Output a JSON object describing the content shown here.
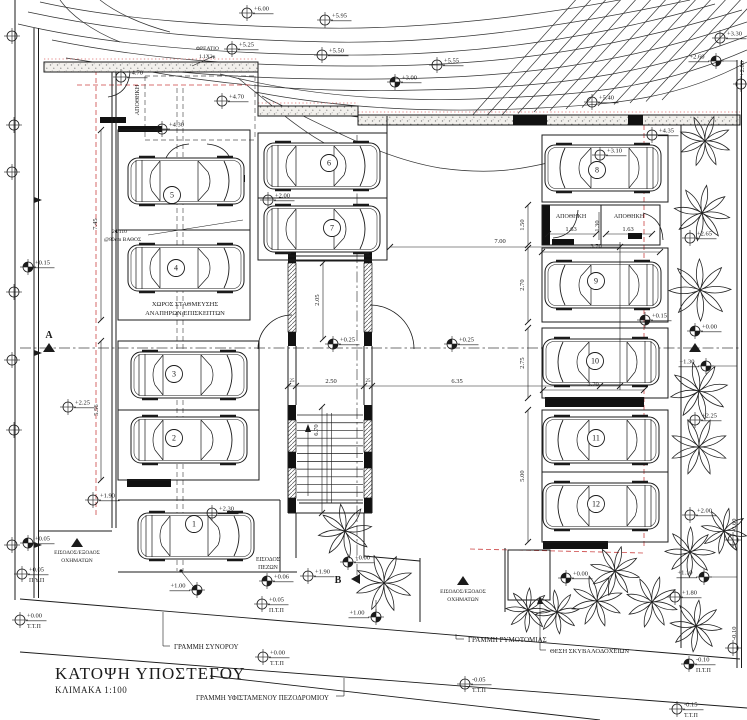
{
  "meta": {
    "title": "ΚΑΤΟΨΗ ΥΠΟΣΤΕΓΟΥ",
    "scale": "ΚΛΙΜΑΚΑ 1:100"
  },
  "palette": {
    "ink": "#1b1b1b",
    "red": "#cc4444",
    "paper": "#ffffff"
  },
  "contours": [
    "M40,2 C120,20 220,26 320,28 C420,30 540,16 640,-4",
    "M28,12 C130,34 230,40 330,42 C440,44 560,28 690,0",
    "M18,24 C120,48 240,54 340,55 C470,56 590,40 715,4",
    "M52,40 C160,62 260,66 360,66 C490,66 600,53 742,10",
    "M66,58 C180,76 280,80 380,79 C510,78 620,66 747,22",
    "M140,70 C250,90 340,92 420,90 C540,88 640,78 747,36",
    "M220,74 C320,100 420,102 500,98 C590,94 660,88 747,50",
    "M255,92 C360,112 460,112 540,108 C620,104 680,98 747,62",
    "M290,108 C400,122 470,121 545,116",
    "M350,116 C440,128 530,125 600,121",
    "M262,96 C330,128 380,158 440,168 C490,175 520,170 560,160",
    "M238,78 C290,120 320,150 380,165",
    "M60,0 C70,14 90,30 120,42",
    "M100,0 C115,12 140,24 170,32"
  ],
  "diag_hatch": {
    "count": 13,
    "x0": 470,
    "y0": 118,
    "stepx": 16,
    "x1": 580,
    "y1": -5,
    "stepx1": 15,
    "dy": -1.5
  },
  "wall_strips": [
    [
      44,
      62,
      214,
      10
    ],
    [
      258,
      106,
      100,
      10
    ],
    [
      358,
      115,
      382,
      10
    ]
  ],
  "black_rects": [
    [
      513,
      115,
      34,
      10
    ],
    [
      628,
      115,
      15,
      10
    ],
    [
      100,
      117,
      26,
      6
    ],
    [
      185,
      175,
      60,
      7
    ],
    [
      118,
      126,
      44,
      6
    ],
    [
      127,
      479,
      44,
      8
    ],
    [
      545,
      397,
      99,
      10
    ],
    [
      542,
      205,
      8,
      40
    ],
    [
      552,
      239,
      22,
      6
    ],
    [
      628,
      233,
      14,
      6
    ],
    [
      543,
      541,
      65,
      8
    ],
    [
      288,
      249,
      8,
      14
    ],
    [
      364,
      249,
      8,
      14
    ],
    [
      288,
      332,
      8,
      14
    ],
    [
      364,
      332,
      8,
      14
    ],
    [
      288,
      405,
      8,
      15
    ],
    [
      364,
      405,
      8,
      15
    ],
    [
      288,
      452,
      8,
      16
    ],
    [
      364,
      452,
      8,
      16
    ],
    [
      288,
      498,
      8,
      15
    ],
    [
      364,
      498,
      8,
      15
    ]
  ],
  "hatch_rects": [
    [
      288,
      263,
      8,
      69
    ],
    [
      364,
      263,
      8,
      69
    ],
    [
      288,
      420,
      8,
      32
    ],
    [
      364,
      420,
      8,
      32
    ],
    [
      288,
      468,
      8,
      30
    ],
    [
      364,
      468,
      8,
      30
    ]
  ],
  "boxes": [
    [
      118,
      130,
      132,
      190
    ],
    [
      118,
      341,
      141,
      139
    ],
    [
      258,
      133,
      129,
      127
    ],
    [
      542,
      135,
      126,
      67
    ],
    [
      542,
      205,
      118,
      40
    ],
    [
      542,
      248,
      126,
      74
    ],
    [
      542,
      328,
      126,
      70
    ],
    [
      542,
      410,
      126,
      62
    ],
    [
      542,
      472,
      126,
      70
    ],
    [
      508,
      550,
      42,
      50
    ]
  ],
  "struct_lines": [
    [
      15,
      0,
      15,
      600
    ],
    [
      34,
      28,
      34,
      598
    ],
    [
      38.5,
      28,
      38.5,
      598
    ],
    [
      112,
      72,
      112,
      528
    ],
    [
      116,
      72,
      116,
      528
    ],
    [
      38,
      531,
      112,
      531
    ],
    [
      258,
      62,
      258,
      106
    ],
    [
      358,
      106,
      358,
      115
    ],
    [
      387,
      116,
      387,
      133
    ],
    [
      118,
      230,
      250,
      230
    ],
    [
      118,
      410,
      259,
      410
    ],
    [
      258,
      198,
      387,
      198
    ],
    [
      118,
      500,
      280,
      500
    ],
    [
      118,
      572,
      297,
      572
    ],
    [
      280,
      500,
      280,
      572
    ],
    [
      601,
      205,
      601,
      245
    ],
    [
      681,
      125,
      681,
      648
    ],
    [
      737,
      60,
      737,
      668
    ],
    [
      741.5,
      60,
      741.5,
      668
    ],
    [
      420,
      558,
      420,
      622
    ],
    [
      505,
      548,
      505,
      612
    ],
    [
      296,
      513,
      296,
      558
    ],
    [
      364,
      513,
      364,
      558
    ],
    [
      364,
      556,
      420,
      561
    ],
    [
      288,
      256,
      372,
      256
    ],
    [
      288,
      261,
      372,
      261
    ],
    [
      288,
      346,
      288,
      405
    ],
    [
      296,
      346,
      296,
      405
    ],
    [
      364,
      346,
      364,
      405
    ],
    [
      372,
      346,
      372,
      405
    ],
    [
      288,
      405,
      288,
      513
    ],
    [
      372,
      405,
      372,
      513
    ],
    [
      288,
      513,
      372,
      513
    ],
    [
      299,
      503,
      363,
      503
    ]
  ],
  "site_lines": [
    [
      20,
      599,
      740,
      659
    ],
    [
      20,
      652,
      747,
      708
    ],
    [
      210,
      676,
      600,
      720
    ]
  ],
  "thin_lines": [
    [
      101,
      130,
      101,
      320
    ],
    [
      101,
      341,
      101,
      480
    ],
    [
      323,
      263,
      323,
      339
    ],
    [
      322,
      407,
      322,
      513
    ],
    [
      287,
      386,
      620,
      386
    ],
    [
      390,
      247,
      620,
      247
    ],
    [
      620,
      242,
      620,
      390
    ],
    [
      528,
      205,
      528,
      245
    ],
    [
      528,
      248,
      528,
      322
    ],
    [
      528,
      328,
      528,
      398
    ],
    [
      528,
      410,
      528,
      542
    ],
    [
      543,
      390,
      644,
      390
    ],
    [
      542,
      252,
      660,
      252
    ],
    [
      548,
      234,
      596,
      234
    ],
    [
      606,
      234,
      652,
      234
    ],
    [
      599,
      212,
      599,
      240
    ],
    [
      546,
      650,
      540,
      650
    ],
    [
      540,
      650,
      540,
      598
    ],
    [
      170,
      646,
      163,
      646
    ],
    [
      163,
      646,
      163,
      612
    ],
    [
      464,
      639,
      456,
      639
    ],
    [
      456,
      639,
      456,
      634
    ],
    [
      336,
      696,
      344,
      696
    ],
    [
      344,
      696,
      344,
      678
    ],
    [
      148,
      235,
      243,
      220
    ],
    [
      214,
      56,
      192,
      66
    ],
    [
      181,
      571,
      193,
      586
    ],
    [
      376,
      612,
      376,
      600
    ],
    [
      716,
      61,
      737,
      61
    ],
    [
      712,
      366,
      737,
      366
    ],
    [
      710,
      577,
      737,
      577
    ],
    [
      327,
      413,
      327,
      503
    ],
    [
      331.5,
      413,
      331.5,
      503
    ],
    [
      308,
      496,
      308,
      428
    ]
  ],
  "dashed_lines": [
    [
      177,
      88,
      177,
      571
    ],
    [
      183,
      88,
      183,
      571
    ],
    [
      145,
      76,
      255,
      76
    ],
    [
      145,
      76,
      145,
      140
    ],
    [
      145,
      140,
      255,
      140
    ],
    [
      255,
      76,
      255,
      140
    ]
  ],
  "dashdot_lines": [
    [
      20,
      348,
      740,
      348
    ],
    [
      357,
      135,
      357,
      578
    ]
  ],
  "red_dash": [
    [
      96,
      70,
      96,
      515
    ],
    [
      644,
      125,
      644,
      547
    ],
    [
      77,
      85,
      250,
      85
    ],
    [
      470,
      549,
      644,
      553
    ]
  ],
  "red_dot": [
    [
      44,
      59,
      258,
      59
    ],
    [
      258,
      103,
      358,
      103
    ],
    [
      358,
      112,
      740,
      112
    ]
  ],
  "door_arcs": [
    "M108,97 Q128,94 130,72",
    "M163,170 Q165,146 189,144",
    "M233,170 Q231,146 207,144",
    "M553,238 Q576,236 578,210",
    "M643,213 Q662,218 663,240",
    "M370,305 A44,44 0 0 1 414,349",
    "M292,315 A34,34 0 0 0 258,349"
  ],
  "stair": {
    "x0": 297,
    "x1": 363,
    "ytop": 415,
    "ybot": 500,
    "steps": 12,
    "arrow": [
      305,
      432,
      311,
      432,
      308,
      424
    ]
  },
  "tick_points": [
    [
      101,
      130
    ],
    [
      101,
      320
    ],
    [
      101,
      341
    ],
    [
      101,
      480
    ],
    [
      323,
      263
    ],
    [
      323,
      339
    ],
    [
      322,
      407
    ],
    [
      322,
      513
    ],
    [
      288,
      386
    ],
    [
      296,
      386
    ],
    [
      364,
      386
    ],
    [
      372,
      386
    ],
    [
      600,
      386
    ],
    [
      620,
      386
    ],
    [
      390,
      247
    ],
    [
      620,
      247
    ],
    [
      528,
      205
    ],
    [
      528,
      245
    ],
    [
      528,
      248
    ],
    [
      528,
      322
    ],
    [
      528,
      328
    ],
    [
      528,
      398
    ],
    [
      528,
      410
    ],
    [
      528,
      542
    ],
    [
      543,
      390
    ],
    [
      644,
      390
    ],
    [
      542,
      252
    ],
    [
      660,
      252
    ],
    [
      548,
      234
    ],
    [
      596,
      234
    ],
    [
      606,
      234
    ],
    [
      652,
      234
    ]
  ],
  "cars": [
    {
      "x": 186,
      "y": 181,
      "m": 0
    },
    {
      "x": 186,
      "y": 268,
      "m": 0
    },
    {
      "x": 189,
      "y": 375,
      "m": 0
    },
    {
      "x": 189,
      "y": 440,
      "m": 0
    },
    {
      "x": 196,
      "y": 536,
      "m": 0
    },
    {
      "x": 322,
      "y": 166,
      "m": 0
    },
    {
      "x": 322,
      "y": 229,
      "m": 0
    },
    {
      "x": 603,
      "y": 168,
      "m": 1
    },
    {
      "x": 603,
      "y": 285,
      "m": 1
    },
    {
      "x": 601,
      "y": 362,
      "m": 1
    },
    {
      "x": 601,
      "y": 440,
      "m": 1
    },
    {
      "x": 601,
      "y": 506,
      "m": 1
    }
  ],
  "space_numbers": [
    {
      "t": "5",
      "x": 172,
      "y": 195
    },
    {
      "t": "4",
      "x": 176,
      "y": 268
    },
    {
      "t": "3",
      "x": 174,
      "y": 374
    },
    {
      "t": "2",
      "x": 174,
      "y": 438
    },
    {
      "t": "1",
      "x": 194,
      "y": 524
    },
    {
      "t": "6",
      "x": 329,
      "y": 163
    },
    {
      "t": "7",
      "x": 332,
      "y": 228
    },
    {
      "t": "8",
      "x": 597,
      "y": 170
    },
    {
      "t": "9",
      "x": 596,
      "y": 281
    },
    {
      "t": "10",
      "x": 595,
      "y": 361
    },
    {
      "t": "11",
      "x": 596,
      "y": 438
    },
    {
      "t": "12",
      "x": 596,
      "y": 504
    }
  ],
  "markers": [
    {
      "t": "+6.00",
      "x": 247,
      "y": 13
    },
    {
      "t": "+5.95",
      "x": 325,
      "y": 20
    },
    {
      "t": "+5.25",
      "x": 232,
      "y": 49
    },
    {
      "t": "+5.50",
      "x": 322,
      "y": 55
    },
    {
      "t": "+5.55",
      "x": 437,
      "y": 65
    },
    {
      "t": "+3.00",
      "x": 395,
      "y": 82,
      "f": 1
    },
    {
      "t": "+4.70",
      "x": 121,
      "y": 77
    },
    {
      "t": "+4.70",
      "x": 222,
      "y": 101
    },
    {
      "t": "+4.30",
      "x": 162,
      "y": 129
    },
    {
      "t": "+5.40",
      "x": 592,
      "y": 102
    },
    {
      "t": "+2.60",
      "x": 716,
      "y": 61,
      "f": 1,
      "side": -1
    },
    {
      "t": "+3.30",
      "x": 720,
      "y": 38
    },
    {
      "t": "+4.35",
      "x": 652,
      "y": 135
    },
    {
      "t": "+2.00",
      "x": 268,
      "y": 200
    },
    {
      "t": "+3.10",
      "x": 600,
      "y": 155
    },
    {
      "t": "+2.65",
      "x": 690,
      "y": 238
    },
    {
      "t": "+0.25",
      "x": 333,
      "y": 344,
      "f": 1
    },
    {
      "t": "+0.25",
      "x": 452,
      "y": 344,
      "f": 1
    },
    {
      "t": "+0.15",
      "x": 28,
      "y": 267,
      "f": 1
    },
    {
      "t": "+0.15",
      "x": 645,
      "y": 320,
      "f": 1
    },
    {
      "t": "+2.25",
      "x": 68,
      "y": 407
    },
    {
      "t": "+2.25",
      "x": 695,
      "y": 420
    },
    {
      "t": "+1.90",
      "x": 93,
      "y": 500
    },
    {
      "t": "+1.90",
      "x": 308,
      "y": 576
    },
    {
      "t": "+2.30",
      "x": 212,
      "y": 513
    },
    {
      "t": "+0.00",
      "x": 695,
      "y": 331,
      "f": 1
    },
    {
      "t": "+1.30",
      "x": 706,
      "y": 366,
      "f": 1,
      "side": -1
    },
    {
      "t": "+2.00",
      "x": 690,
      "y": 515
    },
    {
      "t": "+0.00",
      "x": 348,
      "y": 562,
      "f": 1
    },
    {
      "t": "+0.06",
      "x": 267,
      "y": 581,
      "f": 1
    },
    {
      "t": "+0.05",
      "x": 28,
      "y": 543,
      "f": 1
    },
    {
      "t": "+1.00",
      "x": 197,
      "y": 590,
      "f": 1,
      "side": -1
    },
    {
      "t": "+1.00",
      "x": 376,
      "y": 617,
      "f": 1,
      "side": -1
    },
    {
      "t": "+1.10",
      "x": 704,
      "y": 577,
      "f": 1,
      "side": -1
    },
    {
      "t": "+1.80",
      "x": 675,
      "y": 597
    },
    {
      "t": "+0.00",
      "x": 566,
      "y": 578,
      "f": 1
    },
    {
      "t": "+2.80",
      "x": 741,
      "y": 84,
      "rot": 1
    },
    {
      "t": "-0.60",
      "x": 733,
      "y": 540,
      "rot": 1
    },
    {
      "t": "-0.10",
      "x": 733,
      "y": 648,
      "rot": 1
    },
    {
      "t": "+0.05",
      "x": 22,
      "y": 574,
      "sub": "Π.Υ.Π"
    },
    {
      "t": "+0.00",
      "x": 20,
      "y": 620,
      "sub": "Τ.Τ.Π"
    },
    {
      "t": "+0.05",
      "x": 262,
      "y": 604,
      "sub": "Π.Τ.Π"
    },
    {
      "t": "+0.00",
      "x": 263,
      "y": 657,
      "sub": "Τ.Τ.Π"
    },
    {
      "t": "-0.10",
      "x": 689,
      "y": 664,
      "f": 1,
      "sub": "Π.Τ.Π"
    },
    {
      "t": "-0.15",
      "x": 677,
      "y": 709,
      "sub": "Τ.Τ.Π"
    },
    {
      "t": "-0.05",
      "x": 465,
      "y": 684,
      "sub": "Τ.Τ.Π"
    },
    {
      "t": "",
      "x": 12,
      "y": 36
    },
    {
      "t": "",
      "x": 14,
      "y": 125
    },
    {
      "t": "",
      "x": 12,
      "y": 172
    },
    {
      "t": "",
      "x": 14,
      "y": 292
    },
    {
      "t": "",
      "x": 12,
      "y": 360
    },
    {
      "t": "",
      "x": 14,
      "y": 430
    },
    {
      "t": "",
      "x": 12,
      "y": 545
    }
  ],
  "dims": [
    {
      "t": "7.45",
      "x": 97,
      "y": 224,
      "v": 1
    },
    {
      "t": "5.56",
      "x": 98,
      "y": 410,
      "v": 1
    },
    {
      "t": "2.05",
      "x": 319,
      "y": 300,
      "v": 1
    },
    {
      "t": "6.70",
      "x": 318,
      "y": 430,
      "v": 1
    },
    {
      "t": "2.50",
      "x": 331,
      "y": 383
    },
    {
      "t": "6.35",
      "x": 457,
      "y": 383
    },
    {
      "t": "7.00",
      "x": 500,
      "y": 243
    },
    {
      "t": "1.50",
      "x": 524,
      "y": 225,
      "v": 1
    },
    {
      "t": "2.70",
      "x": 524,
      "y": 285,
      "v": 1
    },
    {
      "t": "2.75",
      "x": 524,
      "y": 363,
      "v": 1
    },
    {
      "t": "5.00",
      "x": 524,
      "y": 476,
      "v": 1
    },
    {
      "t": "3.70",
      "x": 593,
      "y": 386
    },
    {
      "t": "3.70",
      "x": 596,
      "y": 248
    },
    {
      "t": "1.63",
      "x": 571,
      "y": 231
    },
    {
      "t": "1.30",
      "x": 599,
      "y": 226,
      "v": 1
    },
    {
      "t": "1.63",
      "x": 628,
      "y": 231
    },
    {
      "t": "25",
      "x": 292,
      "y": 382
    },
    {
      "t": "25",
      "x": 368,
      "y": 382
    }
  ],
  "labels": [
    {
      "t": "ΧΩΡΟΣ ΣΤΑΘΜΕΥΣΗΣ",
      "x": 185,
      "y": 306,
      "s": 6.5,
      "a": "m"
    },
    {
      "t": "ΑΝΑΠΗΡΩΝ/ΕΠΙΣΚΕΠΤΩΝ",
      "x": 185,
      "y": 315,
      "s": 6.5,
      "a": "m"
    },
    {
      "t": "ΑΠΟΘΗΚΗ",
      "x": 139,
      "y": 100,
      "s": 6,
      "a": "m",
      "r": -90
    },
    {
      "t": "ΑΠΟΘΗΚΗ",
      "x": 571,
      "y": 218,
      "s": 6,
      "a": "m"
    },
    {
      "t": "ΑΠΟΘΗΚΗ",
      "x": 629,
      "y": 218,
      "s": 6,
      "a": "m"
    },
    {
      "t": "ΕΙΣΟΔΟΣ",
      "x": 268,
      "y": 561,
      "s": 5.8,
      "a": "m"
    },
    {
      "t": "ΠΕΖΩΝ",
      "x": 268,
      "y": 569,
      "s": 5.8,
      "a": "m"
    },
    {
      "t": "ΕΙΣΟΔΟΣ/ΕΞΟΔΟΣ",
      "x": 77,
      "y": 554,
      "s": 5.5,
      "a": "m"
    },
    {
      "t": "ΟΧΗΜΑΤΩΝ",
      "x": 77,
      "y": 562,
      "s": 5.5,
      "a": "m"
    },
    {
      "t": "ΕΙΣΟΔΟΣ/ΕΞΟΔΟΣ",
      "x": 463,
      "y": 593,
      "s": 5.5,
      "a": "m"
    },
    {
      "t": "ΟΧΗΜΑΤΩΝ",
      "x": 463,
      "y": 601,
      "s": 5.5,
      "a": "m"
    },
    {
      "t": "ΓΡΑΜΜΗ ΣΥΝΟΡΟΥ",
      "x": 174,
      "y": 649,
      "s": 7,
      "a": "s"
    },
    {
      "t": "ΓΡΑΜΜΗ ΡΥΜΟΤΟΜΙΑΣ",
      "x": 468,
      "y": 642,
      "s": 7,
      "a": "s"
    },
    {
      "t": "ΓΡΑΜΜΗ ΥΦΙΣΤΑΜΕΝΟΥ ΠΕΖΟΔΡΟΜΙΟΥ",
      "x": 196,
      "y": 700,
      "s": 7,
      "a": "s"
    },
    {
      "t": "ΘΕΣΗ ΣΚΥΒΑΛΟΔΟΧΕΙΩΝ",
      "x": 550,
      "y": 653,
      "s": 6.5,
      "a": "s"
    },
    {
      "t": "ΦΡΕΑΤΙΟ",
      "x": 196,
      "y": 50,
      "s": 5.5,
      "a": "s"
    },
    {
      "t": "1.1Χ2μ",
      "x": 199,
      "y": 58,
      "s": 5.5,
      "a": "s"
    },
    {
      "t": "2Φ110",
      "x": 112,
      "y": 233,
      "s": 5.5,
      "a": "s"
    },
    {
      "t": "@80cm ΒΑΘΟΣ",
      "x": 104,
      "y": 241,
      "s": 5.5,
      "a": "s"
    },
    {
      "t": "A",
      "x": 49,
      "y": 338,
      "s": 10,
      "a": "m",
      "b": 1
    },
    {
      "t": "B",
      "x": 338,
      "y": 583,
      "s": 10,
      "a": "m",
      "b": 1
    }
  ],
  "trees": [
    [
      705,
      141,
      26
    ],
    [
      702,
      213,
      28
    ],
    [
      700,
      290,
      31
    ],
    [
      699,
      391,
      29
    ],
    [
      699,
      447,
      29
    ],
    [
      724,
      531,
      23
    ],
    [
      690,
      552,
      25
    ],
    [
      345,
      531,
      27
    ],
    [
      384,
      583,
      29
    ],
    [
      615,
      571,
      25
    ],
    [
      528,
      610,
      22
    ],
    [
      557,
      612,
      22
    ],
    [
      597,
      601,
      26
    ],
    [
      652,
      602,
      26
    ],
    [
      696,
      626,
      26
    ]
  ],
  "triangles": {
    "up": [
      [
        77,
        543
      ],
      [
        463,
        581
      ],
      [
        49,
        348
      ],
      [
        695,
        348
      ]
    ],
    "left": [
      [
        356,
        579
      ]
    ],
    "small_up": [
      [
        540,
        598
      ]
    ],
    "right": [
      [
        38,
        200
      ],
      [
        38,
        353
      ],
      [
        38,
        545
      ]
    ]
  }
}
